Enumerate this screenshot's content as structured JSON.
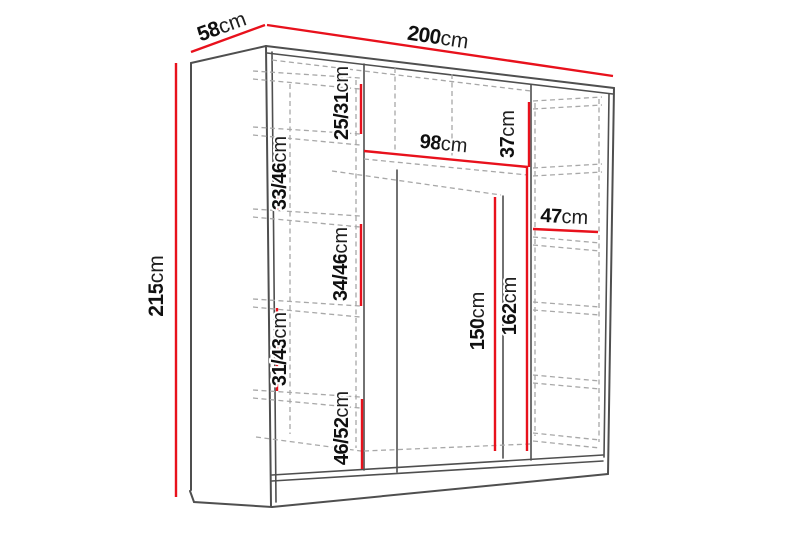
{
  "diagram": {
    "kind": "wardrobe-dimension-drawing",
    "colors": {
      "dimension_line": "#e8111c",
      "edge_line": "#4f4f4f",
      "hidden_line": "#a8a8a8",
      "label_text": "#101010",
      "background": "#ffffff"
    },
    "overall": {
      "width": {
        "num": "200",
        "unit": "cm"
      },
      "depth": {
        "num": "58",
        "unit": "cm"
      },
      "height": {
        "num": "215",
        "unit": "cm"
      }
    },
    "interior": {
      "gap_top_left": {
        "num": "25/31",
        "unit": "cm"
      },
      "gap_left_upper": {
        "num": "33/46",
        "unit": "cm"
      },
      "middle_width": {
        "num": "98",
        "unit": "cm"
      },
      "gap_right_top": {
        "num": "37",
        "unit": "cm"
      },
      "right_width": {
        "num": "47",
        "unit": "cm"
      },
      "gap_left_middle": {
        "num": "34/46",
        "unit": "cm"
      },
      "hanging_height": {
        "num": "150",
        "unit": "cm"
      },
      "side_height": {
        "num": "162",
        "unit": "cm"
      },
      "gap_left_lower": {
        "num": "31/43",
        "unit": "cm"
      },
      "gap_left_bottom": {
        "num": "46/52",
        "unit": "cm"
      }
    }
  }
}
